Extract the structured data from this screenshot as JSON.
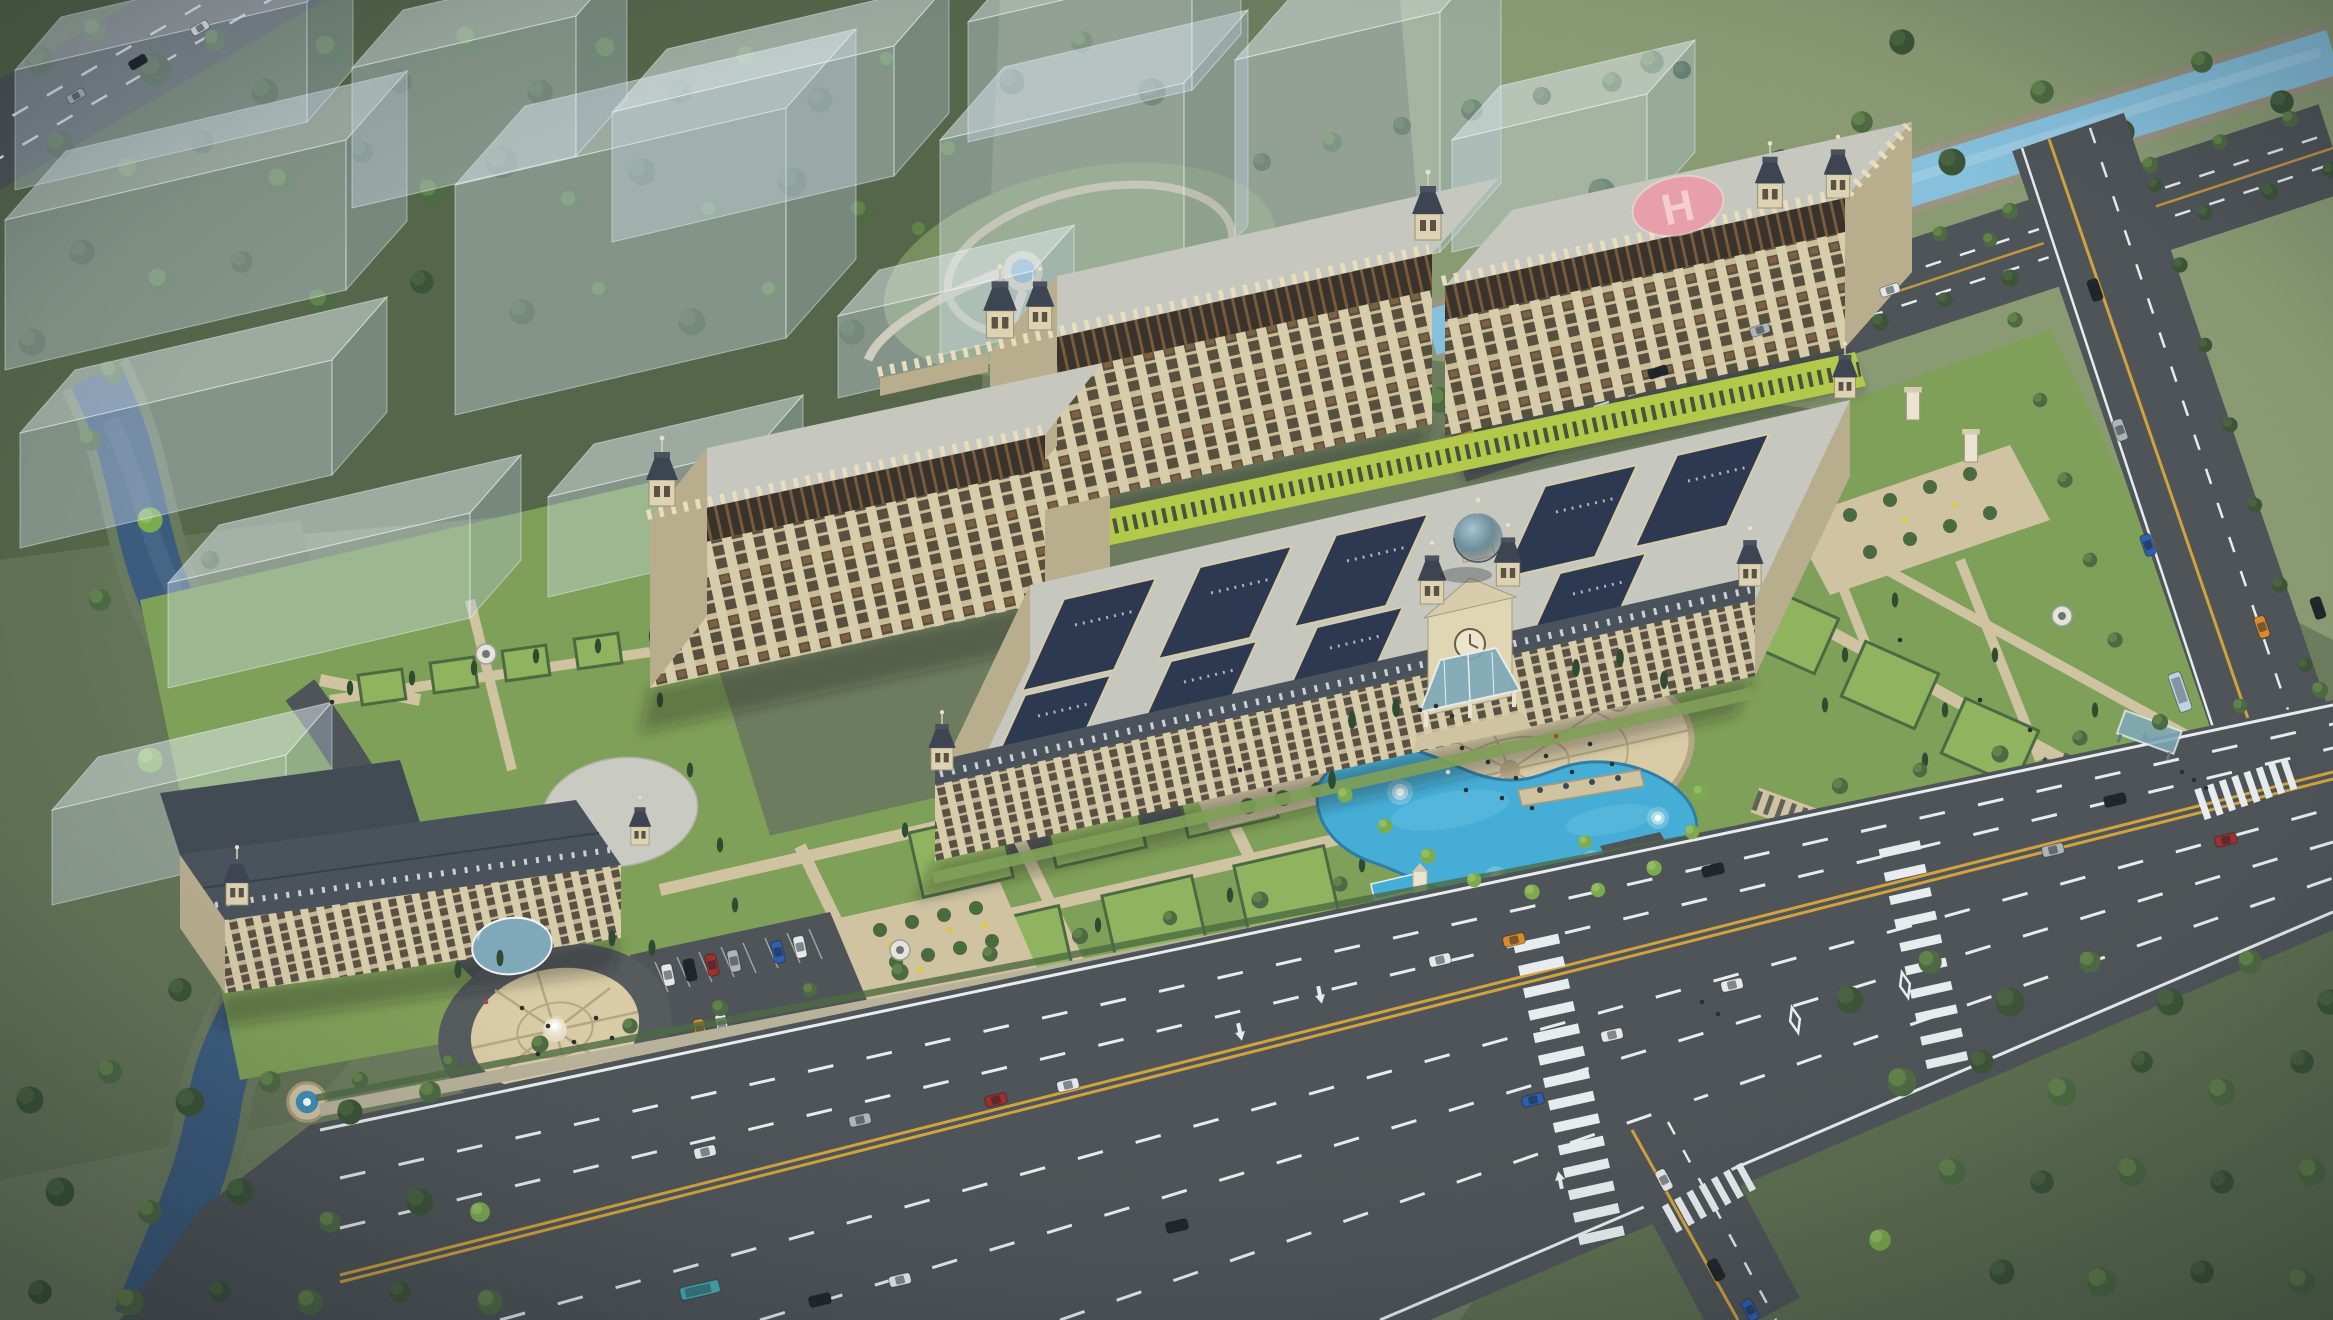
{
  "scene": {
    "type": "aerial-architectural-rendering",
    "view": "bird's-eye three-quarter view at dusk",
    "setting": "European classical-style campus with formal gardens, surrounded by parkland, canals and arterial roads",
    "ghost_context_buildings": 14
  },
  "labels": {
    "helipad_letter": "H"
  },
  "palette": {
    "ground": "#6d7c5e",
    "forest_floor": "#55664a",
    "meadow": "#8a9b74",
    "lawn": "#7fa058",
    "lawn_bright": "#8fb35e",
    "hedge": "#4c6a42",
    "tree_dark": "#3c5438",
    "tree_mid": "#4e6a44",
    "tree_light": "#6f9350",
    "tree_bright": "#7cab4f",
    "cypress": "#2f4c33",
    "road": "#4e5457",
    "road_dark": "#464b4e",
    "road_line": "#e7ecee",
    "road_yellow": "#d2a33c",
    "path": "#cfc3a2",
    "plaza": "#d8cba6",
    "plaza_ring": "#b5a783",
    "canal_dark": "#3c5c7e",
    "canal_light": "#86c0dc",
    "pool": "#46aed6",
    "water_deep": "#2e7ea6",
    "facade": "#d8cdaa",
    "facade_shade": "#b8ae8e",
    "band_dark": "#3a332b",
    "band_slit": "#7d5f3c",
    "roof_flat": "#c6c7bf",
    "roof_slate": "#4a525c",
    "courtyard": "#2d3950",
    "courtyard_edge": "#5a6577",
    "glass": "#7fa9b8",
    "dome": "#5d7f8e",
    "greenstrip": "#b2c94b",
    "helipad": "#e79fab",
    "helipad_letter": "#f4cdd3",
    "stone": "#9a9480",
    "white_stone": "#e9e4d2",
    "car_white": "#e6e8e8",
    "car_black": "#23272b",
    "car_silver": "#aeb4b8",
    "car_red": "#9e2f2f",
    "car_orange": "#d98a2b",
    "car_blue": "#2f5fae",
    "bus_teal": "#49a8b0"
  },
  "inventory": {
    "buildings": [
      {
        "name": "main-highrise-slab",
        "features": [
          "crenellated parapet",
          "cupola corner towers",
          "rooftop helipad with H marking",
          "dark attic band"
        ]
      },
      {
        "name": "west-highrise-slab",
        "features": [
          "cupola corner tower",
          "crenellated parapet"
        ]
      },
      {
        "name": "courtyard-block",
        "features": [
          "9 slate courtyard lightwells",
          "glass dome",
          "twin entrance towers",
          "clock gable",
          "glass entrance canopy"
        ]
      },
      {
        "name": "front-building",
        "features": [
          "slate mansard roof",
          "fan-shaped roof end",
          "arched glass entrance canopy",
          "west tower"
        ]
      }
    ],
    "waterways": [
      {
        "name": "left-canal"
      },
      {
        "name": "upper-right-canal"
      },
      {
        "name": "curved-pool",
        "fountains": 4
      }
    ],
    "roads": [
      {
        "name": "front-boulevard",
        "lanes": 8,
        "median": "double-yellow"
      },
      {
        "name": "east-road"
      },
      {
        "name": "south-road"
      },
      {
        "name": "canal-side-road"
      },
      {
        "name": "corner-road"
      }
    ],
    "site_features": [
      "entrance-plaza-ellipse",
      "circular-plaza",
      "round-fountains",
      "formal-parterre-gardens",
      "lawn-parcels",
      "pergola-walk",
      "parking-lot",
      "bus-shelter",
      "footbridge",
      "gazebos",
      "gate-piers",
      "monument",
      "round-pond"
    ],
    "vehicles": {
      "cars": 34,
      "buses": 3
    },
    "people_visible": true
  }
}
